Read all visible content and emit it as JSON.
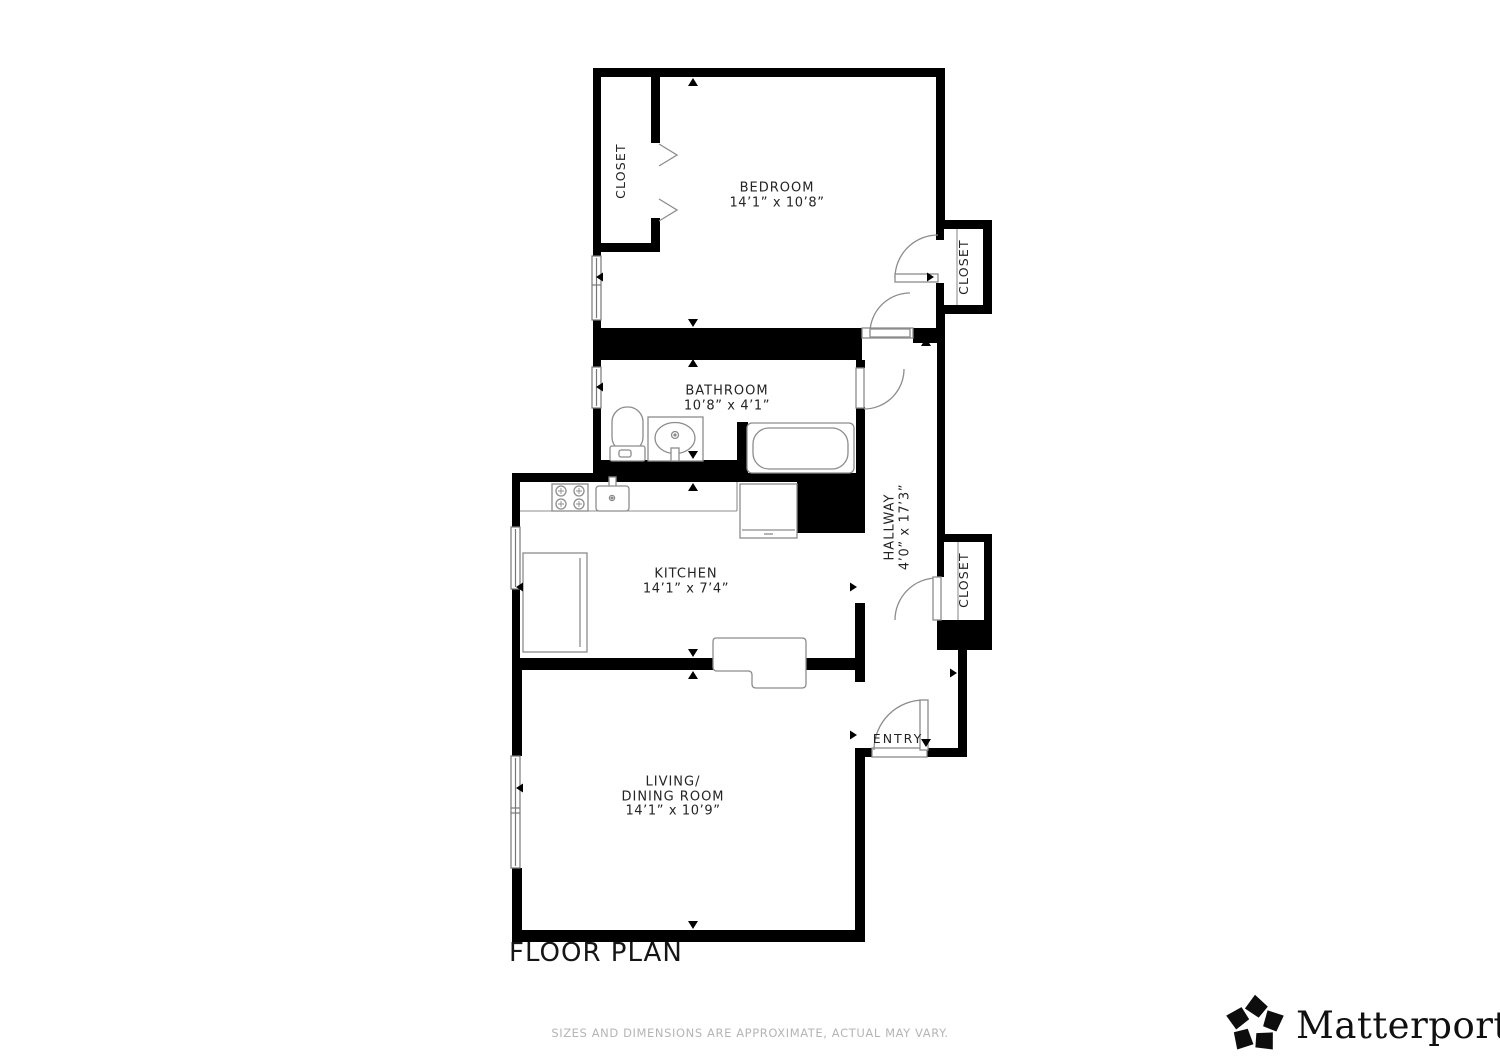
{
  "page": {
    "title": "FLOOR PLAN"
  },
  "footer": {
    "disclaimer": "SIZES AND DIMENSIONS ARE APPROXIMATE, ACTUAL MAY VARY."
  },
  "brand": {
    "name": "Matterport",
    "registered_mark": "®"
  },
  "rooms": {
    "bedroom": {
      "label": "BEDROOM",
      "dims": "14’1” x 10’8”"
    },
    "bathroom": {
      "label": "BATHROOM",
      "dims": "10’8” x 4’1”"
    },
    "kitchen": {
      "label": "KITCHEN",
      "dims": "14’1” x 7’4”"
    },
    "living_dining": {
      "label_line1": "LIVING/",
      "label_line2": "DINING ROOM",
      "dims": "14’1” x 10’9”"
    },
    "hallway": {
      "label": "HALLWAY",
      "dims": "4’0” x 17’3”"
    },
    "entry": {
      "label": "ENTRY"
    },
    "closet_bedroom_left": {
      "label": "CLOSET"
    },
    "closet_bedroom_right": {
      "label": "CLOSET"
    },
    "closet_hallway": {
      "label": "CLOSET"
    }
  },
  "colors": {
    "wall": "#000000",
    "fixture_outline": "#8c8c8c",
    "label_text": "#242424",
    "footer_text": "#b5b5b5",
    "background": "#ffffff"
  }
}
